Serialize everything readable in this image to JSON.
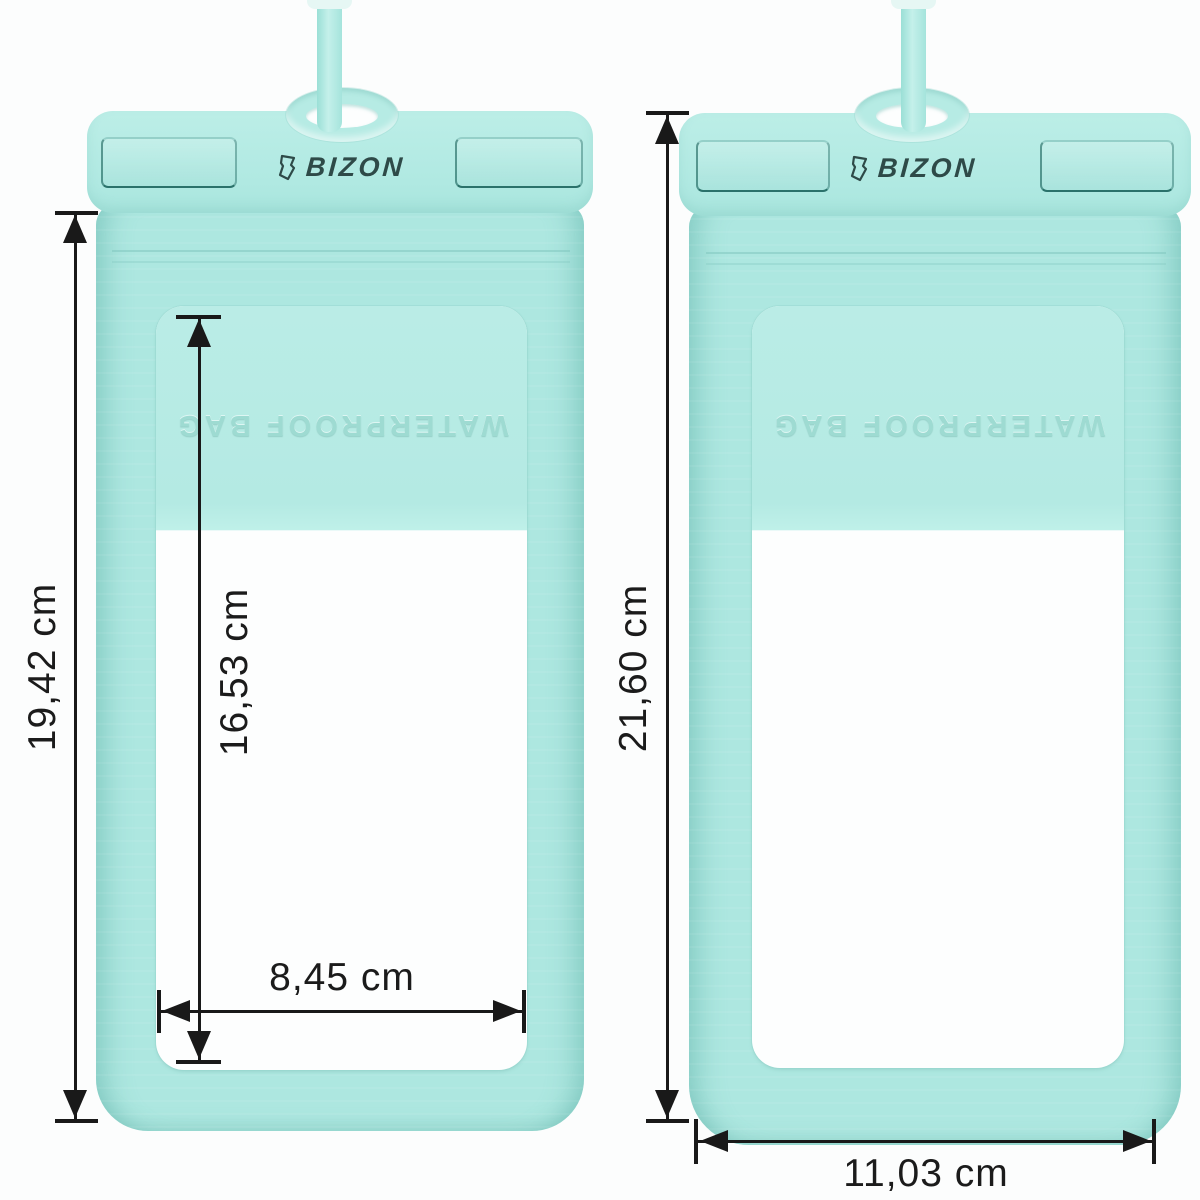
{
  "brand": "BIZON",
  "colors": {
    "pouch_mint": "#ade7e0",
    "pouch_mint_light": "#baece6",
    "pouch_mint_dark": "#8fd8cf",
    "slot_outline": "#1f6e66",
    "logo_color": "#2e4a48",
    "embossed_color": "#9edbd2",
    "dimension_line": "#191919",
    "window_white": "#fdfefe",
    "background": "#fcfdfd"
  },
  "left_pouch": {
    "logo_text": "BIZON",
    "embossed_text": "WATERPROOF BAG",
    "dim_outer_height": "19,42 cm",
    "dim_window_height": "16,53 cm",
    "dim_window_width": "8,45 cm"
  },
  "right_pouch": {
    "logo_text": "BIZON",
    "embossed_text": "WATERPROOF BAG",
    "dim_outer_height": "21,60 cm",
    "dim_outer_width": "11,03 cm"
  }
}
